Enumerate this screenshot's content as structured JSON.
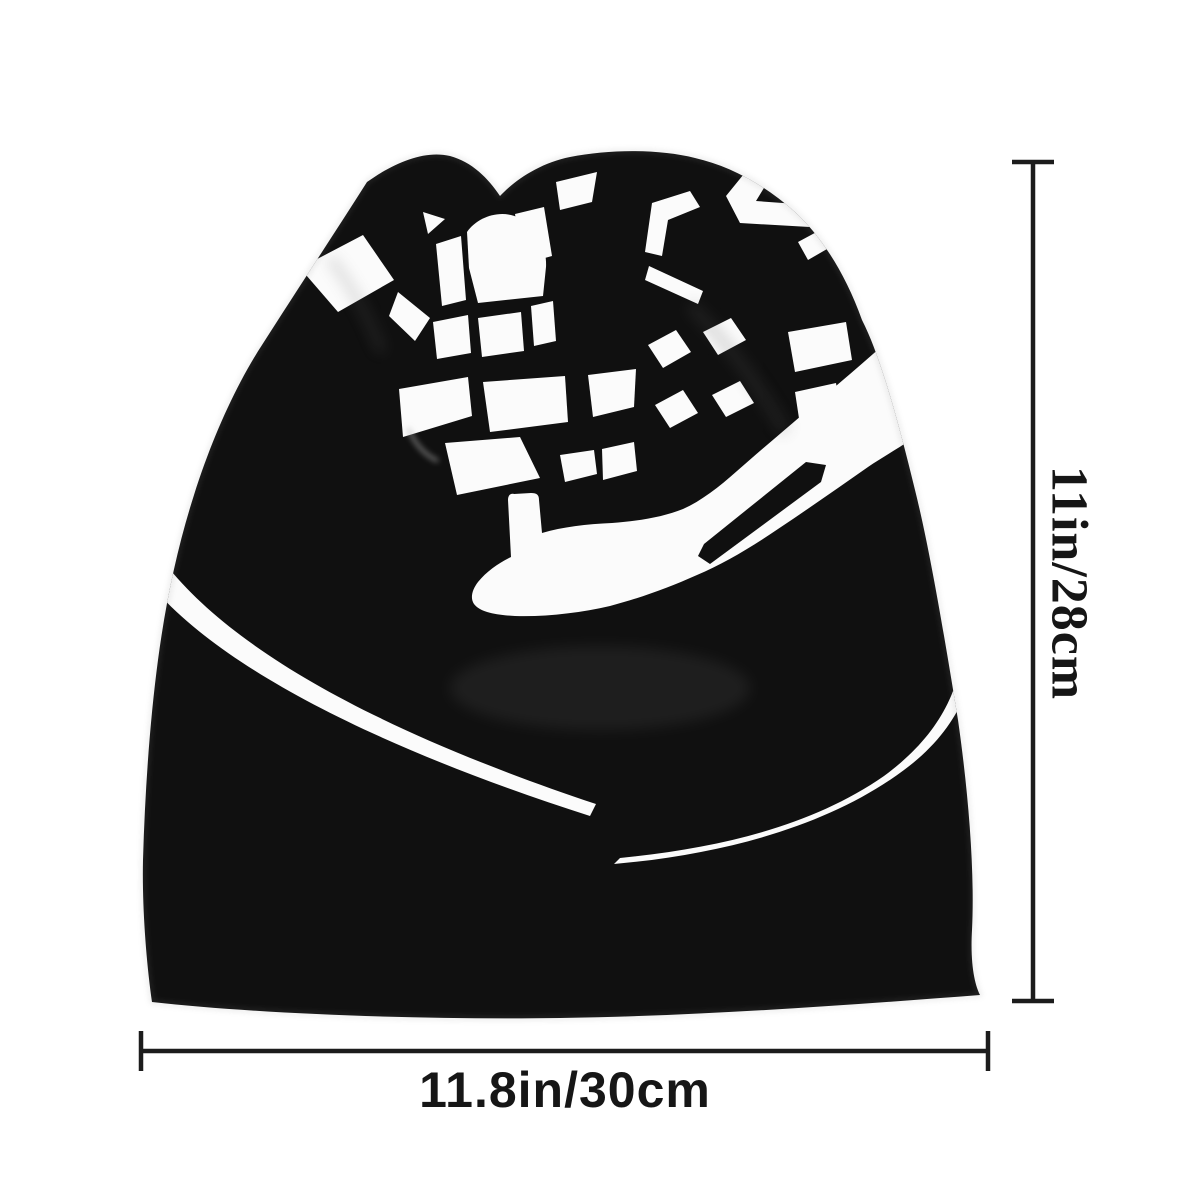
{
  "product_photo": {
    "description": "Black slouchy bonnet beanie hat, front view, printed with a white racing graphic of a hand holding a waving checkered flag with swoosh stripes",
    "hat_color": "#101010",
    "print_color": "#fbfbfb",
    "background_color": "#ffffff"
  },
  "annotations": {
    "line_color": "#1c1c1c",
    "height": {
      "label": "11in/28cm"
    },
    "width": {
      "label": "11.8in/30cm"
    }
  }
}
